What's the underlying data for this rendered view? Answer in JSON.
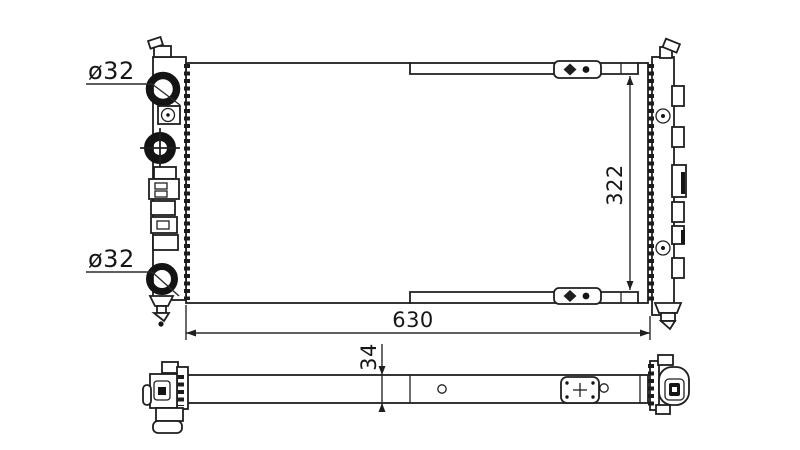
{
  "drawing": {
    "part": "radiator-outline-drawing",
    "background_color": "#ffffff",
    "line_color": "#1f1f1f",
    "labels": {
      "top_port_diameter": "ø32",
      "bottom_port_diameter": "ø32",
      "core_height": "322",
      "core_width": "630",
      "core_depth": "34"
    },
    "icons": {
      "fastener_diamond": "filled-diamond-marker",
      "fastener_dot": "filled-dot-marker"
    }
  }
}
